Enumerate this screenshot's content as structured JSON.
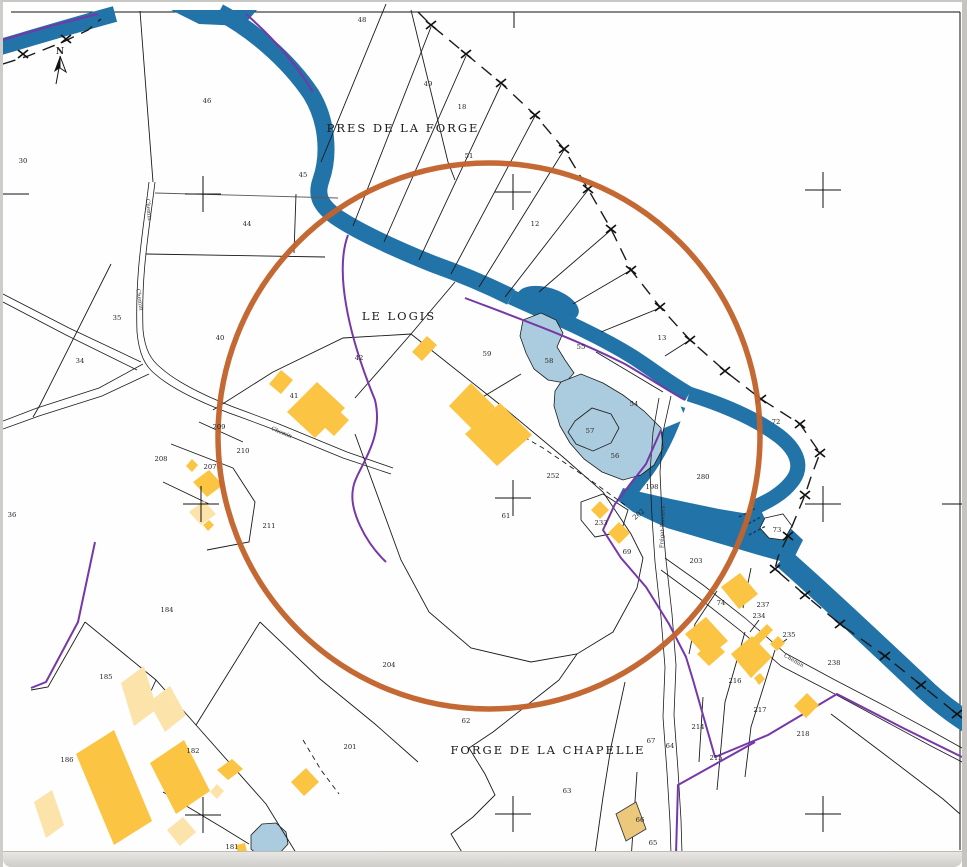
{
  "map": {
    "colors": {
      "paper": "#fefefe",
      "river": "#2273a8",
      "river_dark": "#0f3a5c",
      "pond": "#abccdf",
      "building": "#fcc443",
      "building_light": "#fbe3a9",
      "building_tan": "#ecc87c",
      "boundary": "#7637a8",
      "circle": "#c2632c",
      "line": "#1b1b1b",
      "text": "#222222"
    },
    "north_label": "N",
    "place_labels": [
      {
        "t": "PRES DE LA FORGE",
        "x": 400,
        "y": 130
      },
      {
        "t": "LE LOGIS",
        "x": 396,
        "y": 318
      },
      {
        "t": "FORGE DE LA CHAPELLE",
        "x": 545,
        "y": 752
      }
    ],
    "road_labels": [
      {
        "t": "Chemin",
        "x": 144,
        "y": 208,
        "r": 84
      },
      {
        "t": "Chemin",
        "x": 135,
        "y": 298,
        "r": 80
      },
      {
        "t": "Chemin",
        "x": 278,
        "y": 432,
        "r": 22
      },
      {
        "t": "Chemin",
        "x": 790,
        "y": 660,
        "r": 30
      },
      {
        "t": "Frégat-Ruviers",
        "x": 661,
        "y": 525,
        "r": -88
      }
    ],
    "parcel_labels": [
      {
        "t": "30",
        "x": 20,
        "y": 161
      },
      {
        "t": "46",
        "x": 204,
        "y": 101
      },
      {
        "t": "48",
        "x": 359,
        "y": 20
      },
      {
        "t": "49",
        "x": 425,
        "y": 84
      },
      {
        "t": "18",
        "x": 459,
        "y": 107
      },
      {
        "t": "51",
        "x": 466,
        "y": 156
      },
      {
        "t": "12",
        "x": 532,
        "y": 224
      },
      {
        "t": "13",
        "x": 659,
        "y": 338
      },
      {
        "t": "45",
        "x": 300,
        "y": 175
      },
      {
        "t": "44",
        "x": 244,
        "y": 224
      },
      {
        "t": "40",
        "x": 217,
        "y": 338
      },
      {
        "t": "35",
        "x": 114,
        "y": 318
      },
      {
        "t": "34",
        "x": 77,
        "y": 361
      },
      {
        "t": "36",
        "x": 9,
        "y": 515
      },
      {
        "t": "42",
        "x": 356,
        "y": 358
      },
      {
        "t": "41",
        "x": 291,
        "y": 396
      },
      {
        "t": "209",
        "x": 216,
        "y": 427
      },
      {
        "t": "210",
        "x": 240,
        "y": 451
      },
      {
        "t": "208",
        "x": 158,
        "y": 459
      },
      {
        "t": "207",
        "x": 207,
        "y": 467
      },
      {
        "t": "211",
        "x": 266,
        "y": 526
      },
      {
        "t": "184",
        "x": 164,
        "y": 610
      },
      {
        "t": "185",
        "x": 103,
        "y": 677
      },
      {
        "t": "186",
        "x": 64,
        "y": 760
      },
      {
        "t": "182",
        "x": 190,
        "y": 751
      },
      {
        "t": "181",
        "x": 229,
        "y": 847
      },
      {
        "t": "204",
        "x": 386,
        "y": 665
      },
      {
        "t": "201",
        "x": 347,
        "y": 747
      },
      {
        "t": "59",
        "x": 484,
        "y": 354
      },
      {
        "t": "58",
        "x": 546,
        "y": 361
      },
      {
        "t": "55",
        "x": 578,
        "y": 347
      },
      {
        "t": "54",
        "x": 631,
        "y": 404
      },
      {
        "t": "57",
        "x": 587,
        "y": 431
      },
      {
        "t": "56",
        "x": 612,
        "y": 456
      },
      {
        "t": "252",
        "x": 550,
        "y": 476
      },
      {
        "t": "61",
        "x": 503,
        "y": 516
      },
      {
        "t": "233",
        "x": 598,
        "y": 523
      },
      {
        "t": "69",
        "x": 624,
        "y": 552
      },
      {
        "t": "198",
        "x": 649,
        "y": 487
      },
      {
        "t": "202",
        "x": 637,
        "y": 514,
        "r": -40
      },
      {
        "t": "280",
        "x": 700,
        "y": 477
      },
      {
        "t": "72",
        "x": 773,
        "y": 422
      },
      {
        "t": "73",
        "x": 774,
        "y": 530
      },
      {
        "t": "203",
        "x": 693,
        "y": 561
      },
      {
        "t": "74",
        "x": 718,
        "y": 603
      },
      {
        "t": "237",
        "x": 760,
        "y": 605
      },
      {
        "t": "234",
        "x": 756,
        "y": 616
      },
      {
        "t": "235",
        "x": 786,
        "y": 635
      },
      {
        "t": "238",
        "x": 831,
        "y": 663
      },
      {
        "t": "216",
        "x": 732,
        "y": 681
      },
      {
        "t": "217",
        "x": 757,
        "y": 710
      },
      {
        "t": "214",
        "x": 695,
        "y": 727
      },
      {
        "t": "218",
        "x": 800,
        "y": 734
      },
      {
        "t": "215",
        "x": 713,
        "y": 758
      },
      {
        "t": "62",
        "x": 463,
        "y": 721
      },
      {
        "t": "67",
        "x": 648,
        "y": 741
      },
      {
        "t": "64",
        "x": 667,
        "y": 746
      },
      {
        "t": "63",
        "x": 564,
        "y": 791
      },
      {
        "t": "65",
        "x": 650,
        "y": 843
      },
      {
        "t": "66",
        "x": 637,
        "y": 820
      }
    ],
    "grid_crosses": [
      [
        200,
        192
      ],
      [
        510,
        190
      ],
      [
        820,
        188
      ],
      [
        198,
        502
      ],
      [
        510,
        496
      ],
      [
        820,
        502
      ],
      [
        957,
        502
      ],
      [
        200,
        813
      ],
      [
        510,
        812
      ],
      [
        820,
        812
      ]
    ],
    "boundary_crosses": [
      [
        20,
        52
      ],
      [
        63,
        37
      ],
      [
        428,
        23
      ],
      [
        463,
        52
      ],
      [
        498,
        81
      ],
      [
        532,
        113
      ],
      [
        561,
        147
      ],
      [
        585,
        187
      ],
      [
        608,
        227
      ],
      [
        628,
        268
      ],
      [
        657,
        305
      ],
      [
        687,
        338
      ],
      [
        722,
        369
      ],
      [
        758,
        397
      ],
      [
        797,
        422
      ],
      [
        817,
        451
      ],
      [
        802,
        493
      ],
      [
        785,
        534
      ],
      [
        772,
        567
      ],
      [
        802,
        593
      ],
      [
        837,
        622
      ],
      [
        882,
        654
      ],
      [
        918,
        683
      ],
      [
        954,
        712
      ]
    ]
  }
}
